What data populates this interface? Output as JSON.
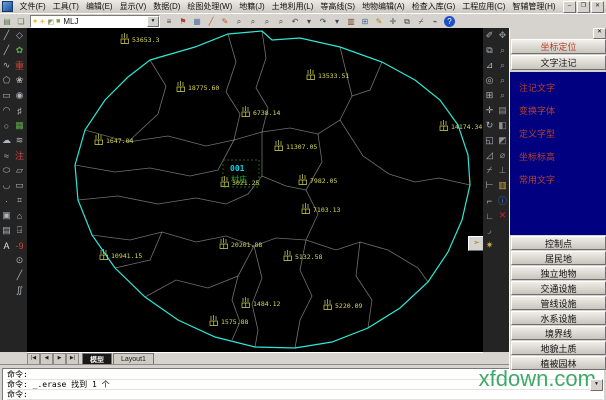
{
  "window": {
    "controls": [
      {
        "name": "minimize-button",
        "glyph": "–"
      },
      {
        "name": "restore-button",
        "glyph": "❐"
      },
      {
        "name": "close-button",
        "glyph": "✕"
      }
    ]
  },
  "menubar": {
    "items": [
      "文件(F)",
      "工具(T)",
      "编辑(E)",
      "显示(V)",
      "数据(D)",
      "绘图处理(W)",
      "地籍(J)",
      "土地利用(L)",
      "等高线(S)",
      "地物编辑(A)",
      "检查入库(G)",
      "工程应用(C)",
      "智辅管理(H)"
    ]
  },
  "toolbar": {
    "left_icons": [
      {
        "name": "layer-manager-icon",
        "glyph": "▤",
        "color": "#5a7a4a"
      },
      {
        "name": "layer-states-icon",
        "glyph": "❏",
        "color": "#5a7a4a"
      }
    ],
    "combo_icons": [
      {
        "name": "layer-on-bulb-icon",
        "glyph": "●",
        "color": "#e0c22a"
      },
      {
        "name": "layer-freeze-sun-icon",
        "glyph": "☀",
        "color": "#d8b020"
      },
      {
        "name": "layer-lock-icon",
        "glyph": "◩",
        "color": "#8a9a6a"
      },
      {
        "name": "layer-color-swatch-icon",
        "glyph": "■",
        "color": "#7aa83a"
      }
    ],
    "layer_combo_value": "MLJ",
    "right_icons": [
      {
        "name": "linetype-icon",
        "glyph": "≡",
        "color": "#3c4450"
      },
      {
        "name": "properties-icon",
        "glyph": "⚑",
        "color": "#b04030"
      },
      {
        "name": "save-icon",
        "glyph": "▦",
        "color": "#5a72a8"
      },
      {
        "name": "draw-line-icon",
        "glyph": "╱",
        "color": "#b06020"
      },
      {
        "name": "redline-pencil-icon",
        "glyph": "✎",
        "color": "#c05020"
      },
      {
        "name": "zoom-realtime-icon",
        "glyph": "⌕",
        "color": "#3c4450"
      },
      {
        "name": "zoom-window-icon",
        "glyph": "⌕",
        "color": "#3c4450"
      },
      {
        "name": "zoom-previous-icon",
        "glyph": "⌕",
        "color": "#3c4450"
      },
      {
        "name": "zoom-all-icon",
        "glyph": "⌕",
        "color": "#3c4450"
      },
      {
        "name": "undo-icon",
        "glyph": "↶",
        "color": "#3c4450"
      },
      {
        "name": "undo-dropdown-icon",
        "glyph": "▾",
        "color": "#3c4450"
      },
      {
        "name": "redo-icon",
        "glyph": "↷",
        "color": "#3c4450"
      },
      {
        "name": "redo-dropdown-icon",
        "glyph": "▾",
        "color": "#3c4450"
      },
      {
        "name": "match-properties-icon",
        "glyph": "▥",
        "color": "#7a4a2a"
      },
      {
        "name": "table-icon",
        "glyph": "⊞",
        "color": "#4a6a9a"
      },
      {
        "name": "edit-pencil-icon",
        "glyph": "✎",
        "color": "#b08020"
      },
      {
        "name": "move-icon",
        "glyph": "✛",
        "color": "#3c4450"
      },
      {
        "name": "copy-icon",
        "glyph": "⧉",
        "color": "#3c4450"
      },
      {
        "name": "trim-icon",
        "glyph": "⌿",
        "color": "#3c4450"
      },
      {
        "name": "erase-icon",
        "glyph": "⌁",
        "color": "#3c4450"
      }
    ],
    "help_label": "?"
  },
  "left_toolbar": {
    "col1": [
      {
        "name": "line-icon",
        "glyph": "╱",
        "color": "#aeb4b8"
      },
      {
        "name": "polyline-icon",
        "glyph": "╱",
        "color": "#aeb4b8"
      },
      {
        "name": "curve-icon",
        "glyph": "∿",
        "color": "#aeb4b8"
      },
      {
        "name": "polygon-icon",
        "glyph": "⬠",
        "color": "#aeb4b8"
      },
      {
        "name": "rectangle-icon",
        "glyph": "▭",
        "color": "#aeb4b8"
      },
      {
        "name": "arc-icon",
        "glyph": "◠",
        "color": "#aeb4b8"
      },
      {
        "name": "circle-icon",
        "glyph": "○",
        "color": "#aeb4b8"
      },
      {
        "name": "revcloud-icon",
        "glyph": "☁",
        "color": "#aeb4b8"
      },
      {
        "name": "spline-icon",
        "glyph": "≈",
        "color": "#aeb4b8"
      },
      {
        "name": "ellipse-icon",
        "glyph": "⬭",
        "color": "#aeb4b8"
      },
      {
        "name": "ellipse-arc-icon",
        "glyph": "◡",
        "color": "#aeb4b8"
      },
      {
        "name": "point-icon",
        "glyph": "·",
        "color": "#aeb4b8"
      },
      {
        "name": "block-insert-icon",
        "glyph": "▣",
        "color": "#aeb4b8"
      },
      {
        "name": "image-icon",
        "glyph": "▤",
        "color": "#aeb4b8"
      },
      {
        "name": "text-icon",
        "glyph": "A",
        "color": "#d8dce0"
      }
    ],
    "col2": [
      {
        "name": "osnap-icon",
        "glyph": "◇",
        "color": "#aeb4b8"
      },
      {
        "name": "plant-icon",
        "glyph": "✿",
        "color": "#5aa84a"
      },
      {
        "name": "redraw-icon",
        "glyph": "重",
        "color": "#d04038"
      },
      {
        "name": "gear-flower-icon",
        "glyph": "❀",
        "color": "#aeb4b8"
      },
      {
        "name": "target-icon",
        "glyph": "◉",
        "color": "#aeb4b8"
      },
      {
        "name": "grid-icon",
        "glyph": "♯",
        "color": "#aeb4b8"
      },
      {
        "name": "filter-icon",
        "glyph": "▦",
        "color": "#5aa84a"
      },
      {
        "name": "waves-icon",
        "glyph": "≋",
        "color": "#aeb4b8"
      },
      {
        "name": "annotate-icon",
        "glyph": "注",
        "color": "#d04038"
      },
      {
        "name": "boundary-icon",
        "glyph": "▱",
        "color": "#aeb4b8"
      },
      {
        "name": "rect-tool-icon",
        "glyph": "▭",
        "color": "#aeb4b8"
      },
      {
        "name": "hatch-icon",
        "glyph": "⌗",
        "color": "#aeb4b8"
      },
      {
        "name": "house-icon",
        "glyph": "⌂",
        "color": "#aeb4b8"
      },
      {
        "name": "station-icon",
        "glyph": "⍈",
        "color": "#aeb4b8"
      },
      {
        "name": "elevation-icon",
        "glyph": "-9",
        "color": "#d04038"
      },
      {
        "name": "circle-dot-icon",
        "glyph": "⊙",
        "color": "#aeb4b8"
      },
      {
        "name": "slope-icon",
        "glyph": "╱",
        "color": "#aeb4b8"
      },
      {
        "name": "double-s-icon",
        "glyph": "∬",
        "color": "#aeb4b8"
      }
    ]
  },
  "right_toolbar": {
    "col1": [
      {
        "name": "erase-pencil-icon",
        "glyph": "✐",
        "color": "#aeb4b8"
      },
      {
        "name": "copy-object-icon",
        "glyph": "⧉",
        "color": "#aeb4b8"
      },
      {
        "name": "mirror-icon",
        "glyph": "⊿",
        "color": "#aeb4b8"
      },
      {
        "name": "offset-icon",
        "glyph": "◎",
        "color": "#aeb4b8"
      },
      {
        "name": "array-icon",
        "glyph": "⊞",
        "color": "#aeb4b8"
      },
      {
        "name": "move-tool-icon",
        "glyph": "✛",
        "color": "#aeb4b8"
      },
      {
        "name": "rotate-icon",
        "glyph": "↻",
        "color": "#aeb4b8"
      },
      {
        "name": "scale-icon",
        "glyph": "◱",
        "color": "#aeb4b8"
      },
      {
        "name": "stretch-icon",
        "glyph": "◿",
        "color": "#aeb4b8"
      },
      {
        "name": "trim-tool-icon",
        "glyph": "⌿",
        "color": "#aeb4b8"
      },
      {
        "name": "extend-icon",
        "glyph": "⊢",
        "color": "#aeb4b8"
      },
      {
        "name": "break-icon",
        "glyph": "⌐",
        "color": "#aeb4b8"
      },
      {
        "name": "chamfer-icon",
        "glyph": "∟",
        "color": "#aeb4b8"
      },
      {
        "name": "fillet-icon",
        "glyph": "◞",
        "color": "#aeb4b8"
      },
      {
        "name": "explode-icon",
        "glyph": "✷",
        "color": "#caa53a"
      }
    ],
    "col2": [
      {
        "name": "pan-icon",
        "glyph": "✥",
        "color": "#8a9094"
      },
      {
        "name": "zoom-rt-icon",
        "glyph": "⌕",
        "color": "#8a9094"
      },
      {
        "name": "zoom-win-icon",
        "glyph": "⌕",
        "color": "#8a9094"
      },
      {
        "name": "zoom-prev-icon",
        "glyph": "⌕",
        "color": "#8a9094"
      },
      {
        "name": "zoom-ext-icon",
        "glyph": "⌕",
        "color": "#8a9094"
      },
      {
        "name": "named-views-icon",
        "glyph": "▤",
        "color": "#8a9094"
      },
      {
        "name": "shade-icon",
        "glyph": "◧",
        "color": "#8a9094"
      },
      {
        "name": "render-icon",
        "glyph": "◩",
        "color": "#8a9094"
      },
      {
        "name": "measure-icon",
        "glyph": "⌀",
        "color": "#8a9094"
      },
      {
        "name": "ucs-icon",
        "glyph": "⊥",
        "color": "#8a9094"
      },
      {
        "name": "image-manager-icon",
        "glyph": "▥",
        "color": "#caa53a"
      },
      {
        "name": "info-icon",
        "glyph": "ⓘ",
        "color": "#3a7ae0"
      },
      {
        "name": "delete-red-icon",
        "glyph": "✕",
        "color": "#d02020"
      }
    ],
    "float_button": {
      "name": "quick-fly-button",
      "glyph": "➣"
    }
  },
  "tabs": {
    "nav": [
      {
        "name": "tab-scroll-first",
        "glyph": "|◀"
      },
      {
        "name": "tab-scroll-prev",
        "glyph": "◀"
      },
      {
        "name": "tab-scroll-next",
        "glyph": "▶"
      },
      {
        "name": "tab-scroll-last",
        "glyph": "▶|"
      }
    ],
    "items": [
      {
        "label": "模型",
        "active": true
      },
      {
        "label": "Layout1",
        "active": false
      }
    ]
  },
  "map": {
    "background": "#000000",
    "boundary_color": "#2de8d8",
    "line_color": "#c8cfc8",
    "label_color": "#d9d955",
    "boundary": [
      [
        123,
        32
      ],
      [
        168,
        19
      ],
      [
        201,
        6
      ],
      [
        235,
        3
      ],
      [
        245,
        12
      ],
      [
        273,
        10
      ],
      [
        313,
        19
      ],
      [
        355,
        34
      ],
      [
        388,
        52
      ],
      [
        413,
        72
      ],
      [
        431,
        97
      ],
      [
        441,
        127
      ],
      [
        443,
        157
      ],
      [
        435,
        192
      ],
      [
        421,
        224
      ],
      [
        401,
        254
      ],
      [
        373,
        280
      ],
      [
        341,
        300
      ],
      [
        305,
        314
      ],
      [
        268,
        320
      ],
      [
        228,
        319
      ],
      [
        188,
        309
      ],
      [
        151,
        292
      ],
      [
        118,
        269
      ],
      [
        88,
        240
      ],
      [
        65,
        207
      ],
      [
        51,
        172
      ],
      [
        48,
        137
      ],
      [
        58,
        102
      ],
      [
        78,
        72
      ],
      [
        101,
        49
      ]
    ],
    "lines": [
      [
        [
          235,
          3
        ],
        [
          239,
          30
        ],
        [
          229,
          60
        ],
        [
          241,
          80
        ],
        [
          235,
          104
        ]
      ],
      [
        [
          201,
          6
        ],
        [
          209,
          34
        ],
        [
          199,
          64
        ],
        [
          213,
          86
        ],
        [
          207,
          112
        ]
      ],
      [
        [
          58,
          102
        ],
        [
          101,
          114
        ],
        [
          141,
          108
        ],
        [
          179,
          118
        ],
        [
          207,
          112
        ]
      ],
      [
        [
          48,
          137
        ],
        [
          88,
          144
        ],
        [
          123,
          140
        ],
        [
          163,
          148
        ],
        [
          191,
          142
        ],
        [
          207,
          112
        ]
      ],
      [
        [
          51,
          172
        ],
        [
          91,
          168
        ],
        [
          131,
          176
        ],
        [
          169,
          170
        ],
        [
          199,
          176
        ],
        [
          221,
          166
        ],
        [
          235,
          148
        ],
        [
          235,
          104
        ]
      ],
      [
        [
          207,
          112
        ],
        [
          235,
          104
        ]
      ],
      [
        [
          235,
          104
        ],
        [
          263,
          100
        ],
        [
          291,
          106
        ],
        [
          313,
          92
        ],
        [
          325,
          68
        ],
        [
          313,
          19
        ]
      ],
      [
        [
          291,
          106
        ],
        [
          295,
          134
        ],
        [
          279,
          162
        ],
        [
          291,
          186
        ],
        [
          279,
          212
        ]
      ],
      [
        [
          235,
          148
        ],
        [
          259,
          158
        ],
        [
          279,
          162
        ]
      ],
      [
        [
          65,
          207
        ],
        [
          103,
          212
        ],
        [
          135,
          204
        ],
        [
          169,
          214
        ],
        [
          199,
          208
        ],
        [
          227,
          218
        ],
        [
          249,
          210
        ],
        [
          279,
          212
        ]
      ],
      [
        [
          279,
          212
        ],
        [
          309,
          222
        ],
        [
          333,
          214
        ],
        [
          361,
          222
        ],
        [
          391,
          240
        ],
        [
          401,
          254
        ]
      ],
      [
        [
          118,
          269
        ],
        [
          149,
          252
        ],
        [
          181,
          260
        ],
        [
          211,
          248
        ],
        [
          227,
          218
        ]
      ],
      [
        [
          227,
          218
        ],
        [
          235,
          250
        ],
        [
          225,
          276
        ],
        [
          231,
          302
        ],
        [
          228,
          319
        ]
      ],
      [
        [
          279,
          212
        ],
        [
          273,
          242
        ],
        [
          285,
          268
        ],
        [
          273,
          292
        ],
        [
          268,
          320
        ]
      ],
      [
        [
          333,
          214
        ],
        [
          329,
          248
        ],
        [
          345,
          272
        ],
        [
          341,
          300
        ]
      ],
      [
        [
          443,
          157
        ],
        [
          412,
          150
        ],
        [
          388,
          154
        ],
        [
          362,
          146
        ],
        [
          336,
          128
        ],
        [
          313,
          92
        ]
      ],
      [
        [
          211,
          248
        ],
        [
          205,
          272
        ],
        [
          213,
          294
        ],
        [
          205,
          312
        ]
      ],
      [
        [
          135,
          204
        ],
        [
          123,
          232
        ],
        [
          88,
          240
        ]
      ],
      [
        [
          123,
          32
        ],
        [
          139,
          58
        ],
        [
          131,
          86
        ],
        [
          101,
          114
        ]
      ],
      [
        [
          355,
          34
        ],
        [
          343,
          62
        ],
        [
          325,
          68
        ]
      ]
    ],
    "labels": [
      {
        "x": 95,
        "y": 10,
        "text": "53653.3"
      },
      {
        "x": 151,
        "y": 58,
        "text": "18775.60"
      },
      {
        "x": 281,
        "y": 46,
        "text": "13533.51"
      },
      {
        "x": 216,
        "y": 83,
        "text": "6738.14"
      },
      {
        "x": 69,
        "y": 111,
        "text": "1647.04"
      },
      {
        "x": 249,
        "y": 117,
        "text": "11307.05"
      },
      {
        "x": 414,
        "y": 97,
        "text": "14174.34"
      },
      {
        "x": 273,
        "y": 151,
        "text": "7982.05"
      },
      {
        "x": 195,
        "y": 153,
        "text": "3021.25"
      },
      {
        "x": 276,
        "y": 180,
        "text": "7103.13"
      },
      {
        "x": 194,
        "y": 215,
        "text": "20201.88"
      },
      {
        "x": 258,
        "y": 227,
        "text": "5132.58"
      },
      {
        "x": 74,
        "y": 226,
        "text": "10941.15"
      },
      {
        "x": 216,
        "y": 274,
        "text": "1484.12"
      },
      {
        "x": 298,
        "y": 276,
        "text": "5220.09"
      },
      {
        "x": 184,
        "y": 292,
        "text": "1575.88"
      }
    ],
    "selection": {
      "rect": [
        196,
        132,
        36,
        27
      ],
      "label_top": "001",
      "label_top_color": "#00d8e8",
      "label_bottom": "村庄",
      "label_bottom_color": "#2fae2f"
    }
  },
  "right_panel": {
    "close_glyph": "✕",
    "top_buttons": [
      {
        "name": "coordinate-locate-button",
        "label": "坐标定位",
        "color": "#b5402a"
      },
      {
        "name": "text-annotation-button",
        "label": "文字注记",
        "color": "#1a1a1a"
      }
    ],
    "nav_items": [
      "注记文字",
      "变换字体",
      "定义字型",
      "坐标标高",
      "常用文字"
    ],
    "category_buttons": [
      "控制点",
      "居民地",
      "独立地物",
      "交通设施",
      "管线设施",
      "水系设施",
      "境界线",
      "地貌土质",
      "植被园林"
    ]
  },
  "command": {
    "lines": [
      "命令:",
      "命令: _.erase 找到 1 个",
      "命令:"
    ],
    "watermark": "xfdown.com"
  }
}
